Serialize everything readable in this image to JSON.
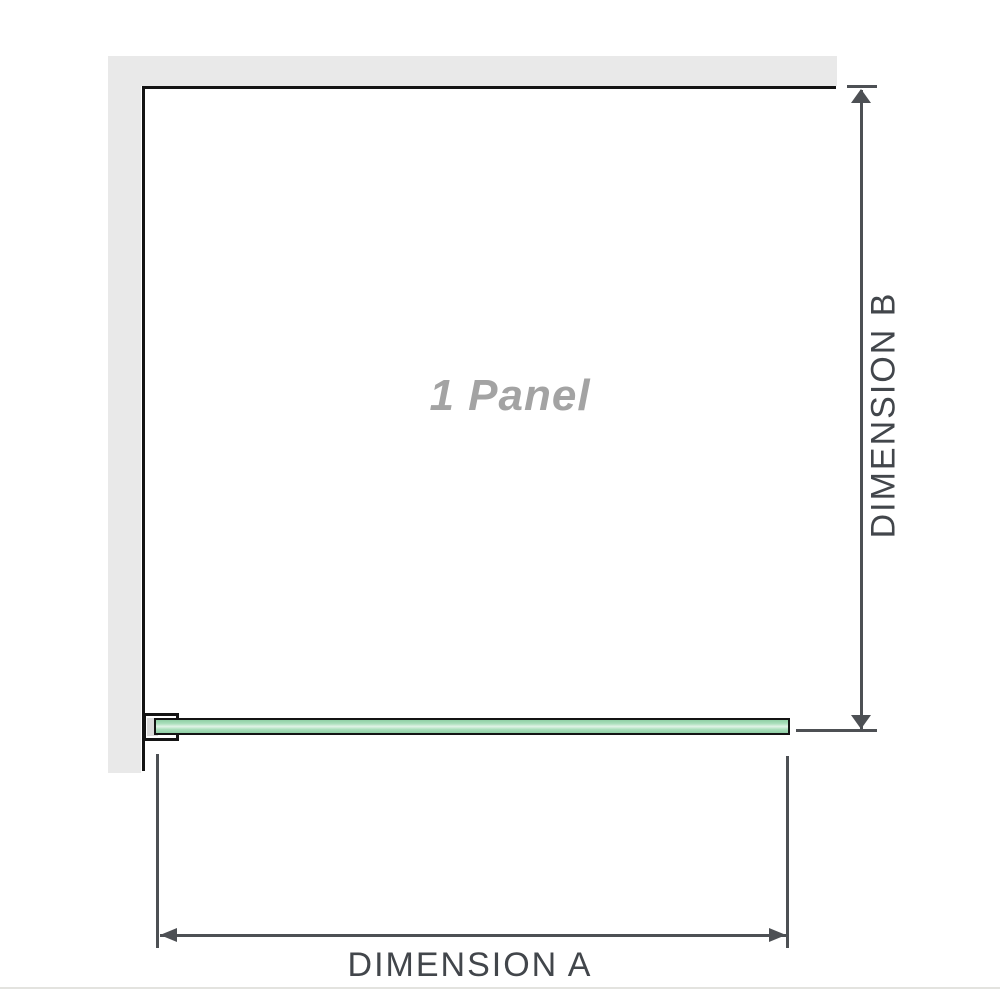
{
  "diagram": {
    "panel_label": "1 Panel",
    "dim_a": {
      "label": "DIMENSION A"
    },
    "dim_b": {
      "label": "DIMENSION B"
    }
  },
  "colors": {
    "background": "#ffffff",
    "wall_fill": "#e9e9e9",
    "outline_black": "#141414",
    "dimension_gray": "#4d5054",
    "dim_label_text": "#42464b",
    "panel_label_text": "#a3a3a3",
    "glass_edge_green": "#8fcfa5",
    "glass_mid_green": "#abdfbc",
    "glass_center_green": "#e2f4e8",
    "bracket_inner_gray": "#dbdbdb",
    "separator_line": "#e3e3df"
  }
}
